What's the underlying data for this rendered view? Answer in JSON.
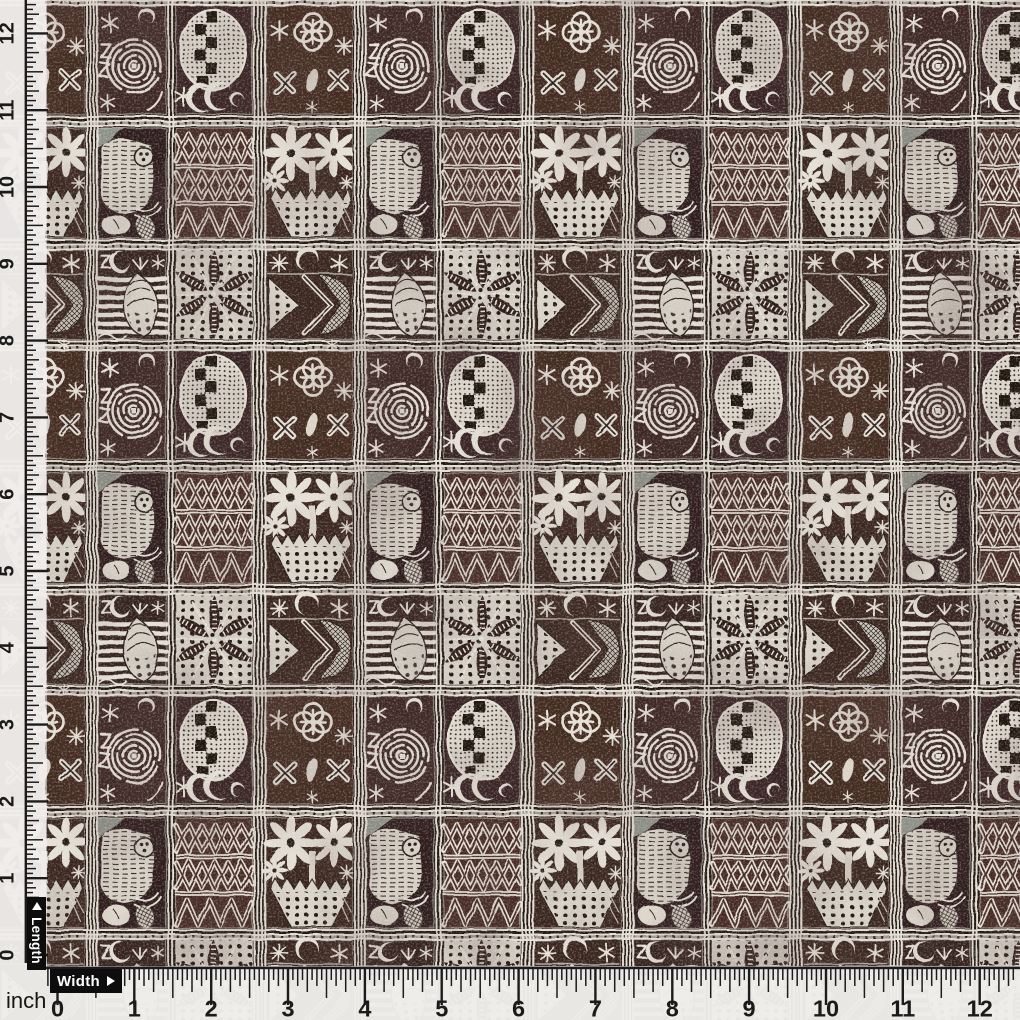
{
  "photo": {
    "subject": "brown and off-white African tapa adinkra style tribal print fabric swatch with measuring rulers",
    "motifs": [
      "spiral",
      "dotted-oval-with-checkerboard",
      "quatrefoil-clover",
      "six-point-star",
      "eight-point-star",
      "crescent-moon",
      "letter-z",
      "zigzag-triangle-rows",
      "eight-petal-flower",
      "dotted-basket",
      "palm-starburst",
      "striped-shell",
      "dotted-chevron-arrow",
      "bird-figure"
    ],
    "colors": {
      "ground": "#3d2520",
      "ink": "#e8e2d6",
      "selvage": "#e9e7e3",
      "accent_green": "#9fa89c"
    }
  },
  "rulers": {
    "unit": "inch",
    "left": {
      "label": "Length",
      "numbers": [
        "0",
        "1",
        "2",
        "3",
        "4",
        "5",
        "6",
        "7",
        "8",
        "9",
        "10",
        "11",
        "12"
      ]
    },
    "bottom": {
      "label": "Width",
      "numbers": [
        "0",
        "1",
        "2",
        "3",
        "4",
        "5",
        "6",
        "7",
        "8",
        "9",
        "10",
        "11",
        "12"
      ]
    }
  },
  "icons": {
    "length_arrow": "up-arrow",
    "width_arrow": "right-arrow"
  }
}
